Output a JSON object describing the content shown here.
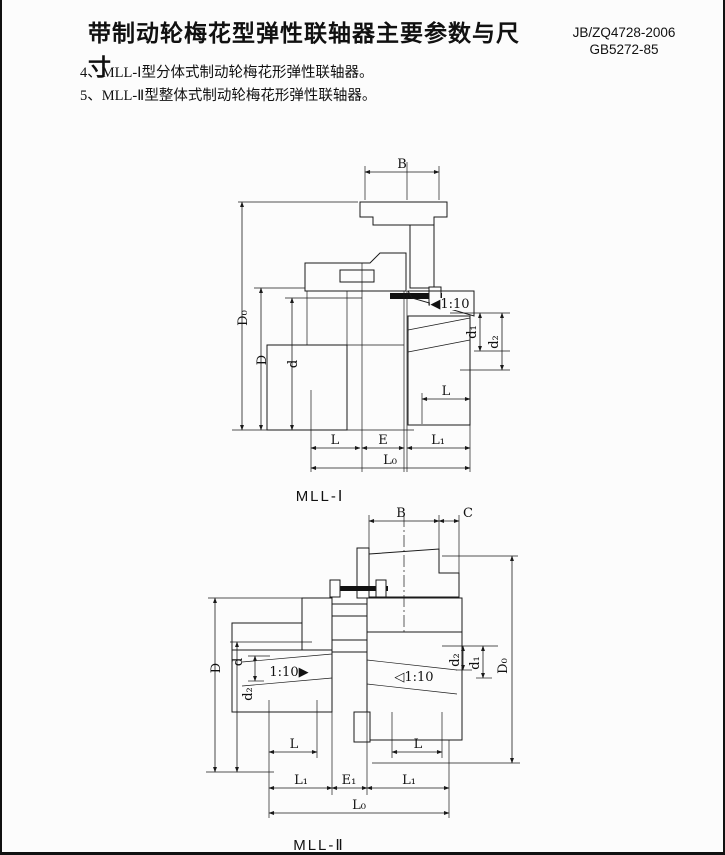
{
  "page": {
    "title": "带制动轮梅花型弹性联轴器主要参数与尺寸",
    "standard_line1": "JB/ZQ4728-2006",
    "standard_line2": "GB5272-85",
    "note_4": "4、MLL-Ⅰ型分体式制动轮梅花形弹性联轴器。",
    "note_5": "5、MLL-Ⅱ型整体式制动轮梅花形弹性联轴器。"
  },
  "figure1": {
    "caption": "MLL-Ⅰ",
    "labels": {
      "B": "B",
      "D0": "D₀",
      "D": "D",
      "d": "d",
      "d1": "d₁",
      "d2": "d₂",
      "L_shaft": "L",
      "L": "L",
      "E": "E",
      "L1": "L₁",
      "L0": "L₀",
      "taper": "◀1:10"
    }
  },
  "figure2": {
    "caption": "MLL-Ⅱ",
    "labels": {
      "B": "B",
      "C": "C",
      "D": "D",
      "d": "d",
      "d2_left": "d₂",
      "d2_right": "d₂",
      "d1": "d₁",
      "D0": "D₀",
      "taper_left": "1:10▶",
      "taper_right": "◁1:10",
      "L_left": "L",
      "L_right": "L",
      "L1_left": "L₁",
      "E1": "E₁",
      "L1_right": "L₁",
      "L0": "L₀"
    }
  }
}
